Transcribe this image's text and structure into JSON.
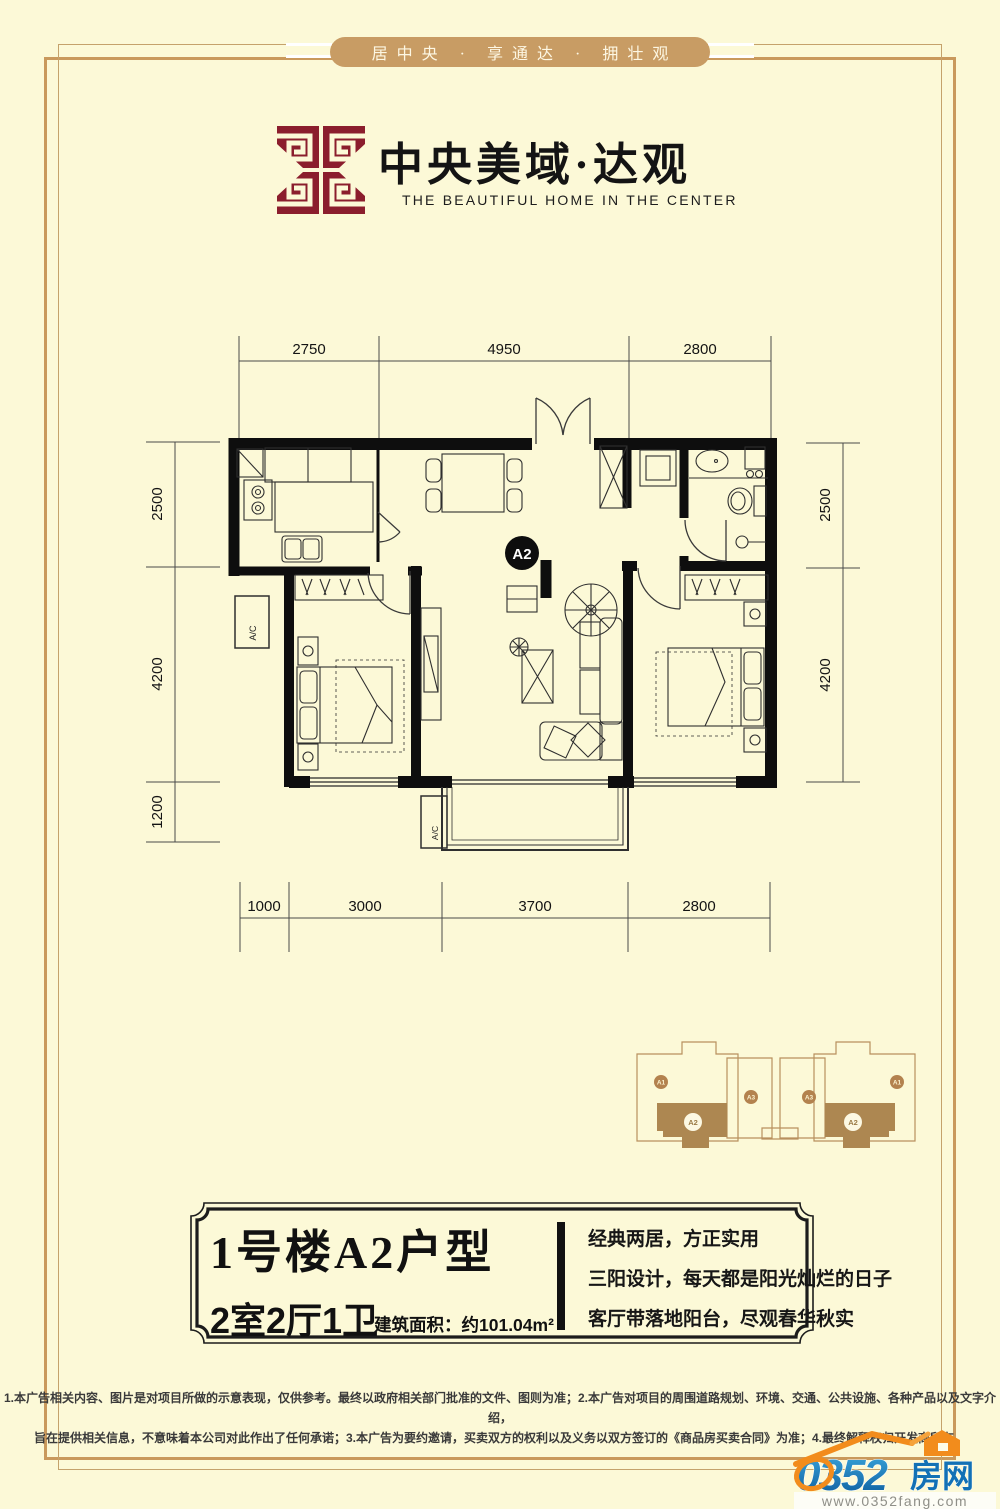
{
  "page": {
    "background": "#fcf9d7",
    "frame_color": "#c9995c"
  },
  "banner": {
    "text": "居中央 · 享通达 · 拥壮观"
  },
  "brand": {
    "title": "中央美域·达观",
    "subtitle": "THE BEAUTIFUL HOME IN THE CENTER",
    "emblem_color": "#8b1e2d"
  },
  "floorplan": {
    "badge": "A2",
    "ac_label": "A/C",
    "dims_top": [
      "2750",
      "4950",
      "2800"
    ],
    "dims_bottom": [
      "1000",
      "3000",
      "3700",
      "2800"
    ],
    "dims_left": [
      "2500",
      "4200",
      "1200"
    ],
    "dims_right": [
      "2500",
      "4200"
    ]
  },
  "keyplan": {
    "a1": "A1",
    "a2": "A2",
    "a3": "A3"
  },
  "infobox": {
    "title": "1号楼A2户型",
    "rooms": "2室2厅1卫",
    "area": "建筑面积：约101.04m²",
    "features": [
      "经典两居，方正实用",
      "三阳设计，每天都是阳光灿烂的日子",
      "客厅带落地阳台，尽观春华秋实"
    ]
  },
  "disclaimer": {
    "line1": "1.本广告相关内容、图片是对项目所做的示意表现，仅供参考。最终以政府相关部门批准的文件、图则为准；2.本广告对项目的周围道路规划、环境、交通、公共设施、各种产品以及文字介绍，",
    "line2": "旨在提供相关信息，不意味着本公司对此作出了任何承诺；3.本广告为要约邀请，买卖双方的权利以及义务以双方签订的《商品房买卖合同》为准；4.最终解释权归开发商所有。"
  },
  "watermark": {
    "number": "0352",
    "cn": "房网",
    "url": "www.0352fang.com"
  }
}
